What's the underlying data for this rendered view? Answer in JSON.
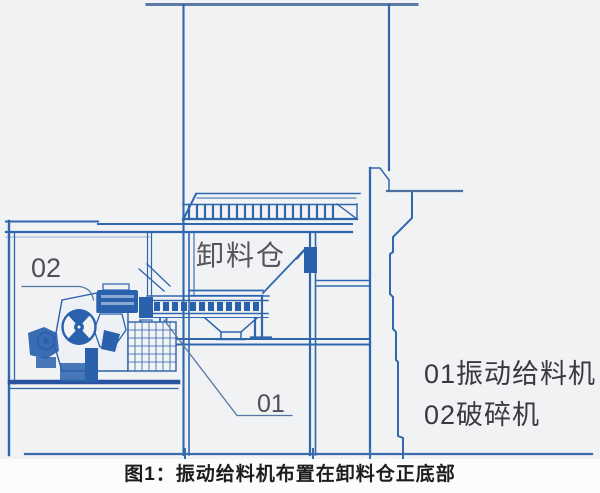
{
  "diagram": {
    "bin_label": "卸料仓",
    "callout_01": "01",
    "callout_02": "02",
    "legend": [
      {
        "code": "01",
        "name": "振动给料机",
        "full": "01振动给料机"
      },
      {
        "code": "02",
        "name": "破碎机",
        "full": "02破碎机"
      }
    ],
    "caption": "图1：振动给料机布置在卸料仓正底部",
    "colors": {
      "line_blue": "#2f66ad",
      "dark_blue": "#2a61ad",
      "steel_blue_border": "#5b7aa6",
      "background_paper": "#f1f2f4",
      "caption_strip": "#fcfcfd",
      "label_gray": "#55565c",
      "legend_text": "#3a3a3e",
      "caption_black": "#1d1d1f"
    }
  }
}
